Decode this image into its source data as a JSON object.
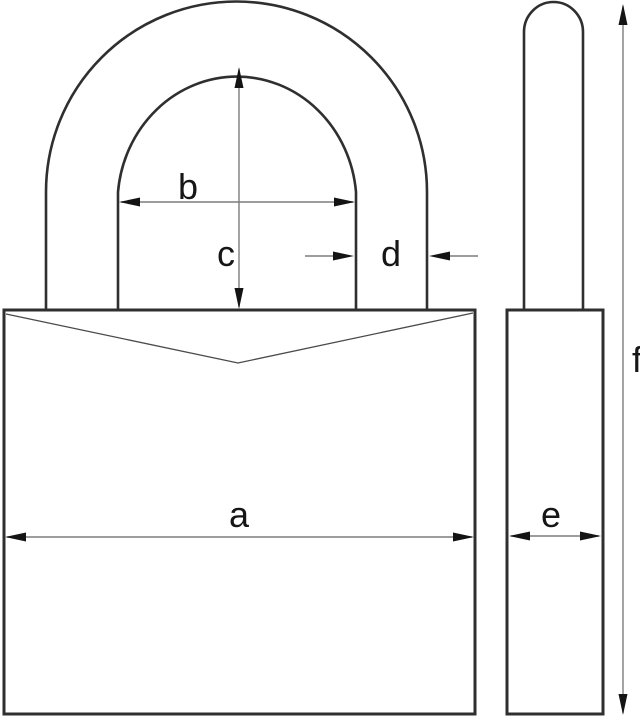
{
  "diagram": {
    "type": "technical-drawing",
    "subject": "padlock dimension diagram with front view and side view",
    "background": "#ffffff",
    "colors": {
      "outline": "#2f2f2f",
      "dimension_line": "#7d7d7d",
      "arrowhead": "#141414",
      "label_text": "#161616"
    },
    "front_view": {
      "dimension_a_label": "a",
      "dimension_b_label": "b",
      "dimension_c_label": "c",
      "dimension_d_label": "d"
    },
    "side_view": {
      "dimension_e_label": "e",
      "dimension_f_label": "f"
    }
  }
}
